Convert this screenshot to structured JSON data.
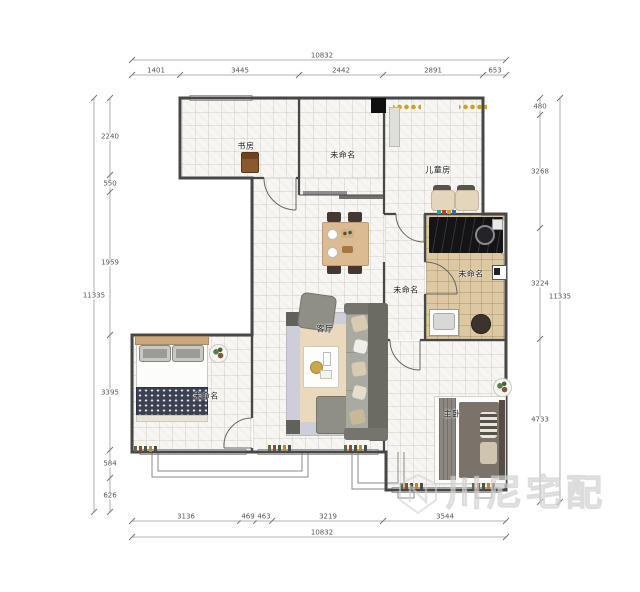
{
  "watermark": {
    "text": "川尼宅配"
  },
  "rooms": {
    "study": "书房",
    "unnamed_top": "未命名",
    "children": "儿童房",
    "kitchen": "未命名",
    "hallway": "未命名",
    "living": "客厅",
    "bedroom_left": "未命名",
    "master": "主卧"
  },
  "dims": {
    "top_total": "10832",
    "top": [
      "1401",
      "3445",
      "2442",
      "2891",
      "653"
    ],
    "bottom": [
      "3136",
      "469",
      "463",
      "3219",
      "3544"
    ],
    "bottom_total": "10832",
    "left_total": "11335",
    "left": [
      "2240",
      "550",
      "1959",
      "3395",
      "584",
      "626"
    ],
    "right": [
      "480",
      "3268",
      "3224",
      "4733"
    ],
    "right_total": "11335"
  },
  "colors": {
    "wall": "#474747",
    "kitchen_counter": "#141417",
    "kitchen_floor": "#dcc9a2",
    "gold_decor": "#c9a227",
    "blanket": "#3b4152",
    "sofa": "#6b6b62"
  }
}
